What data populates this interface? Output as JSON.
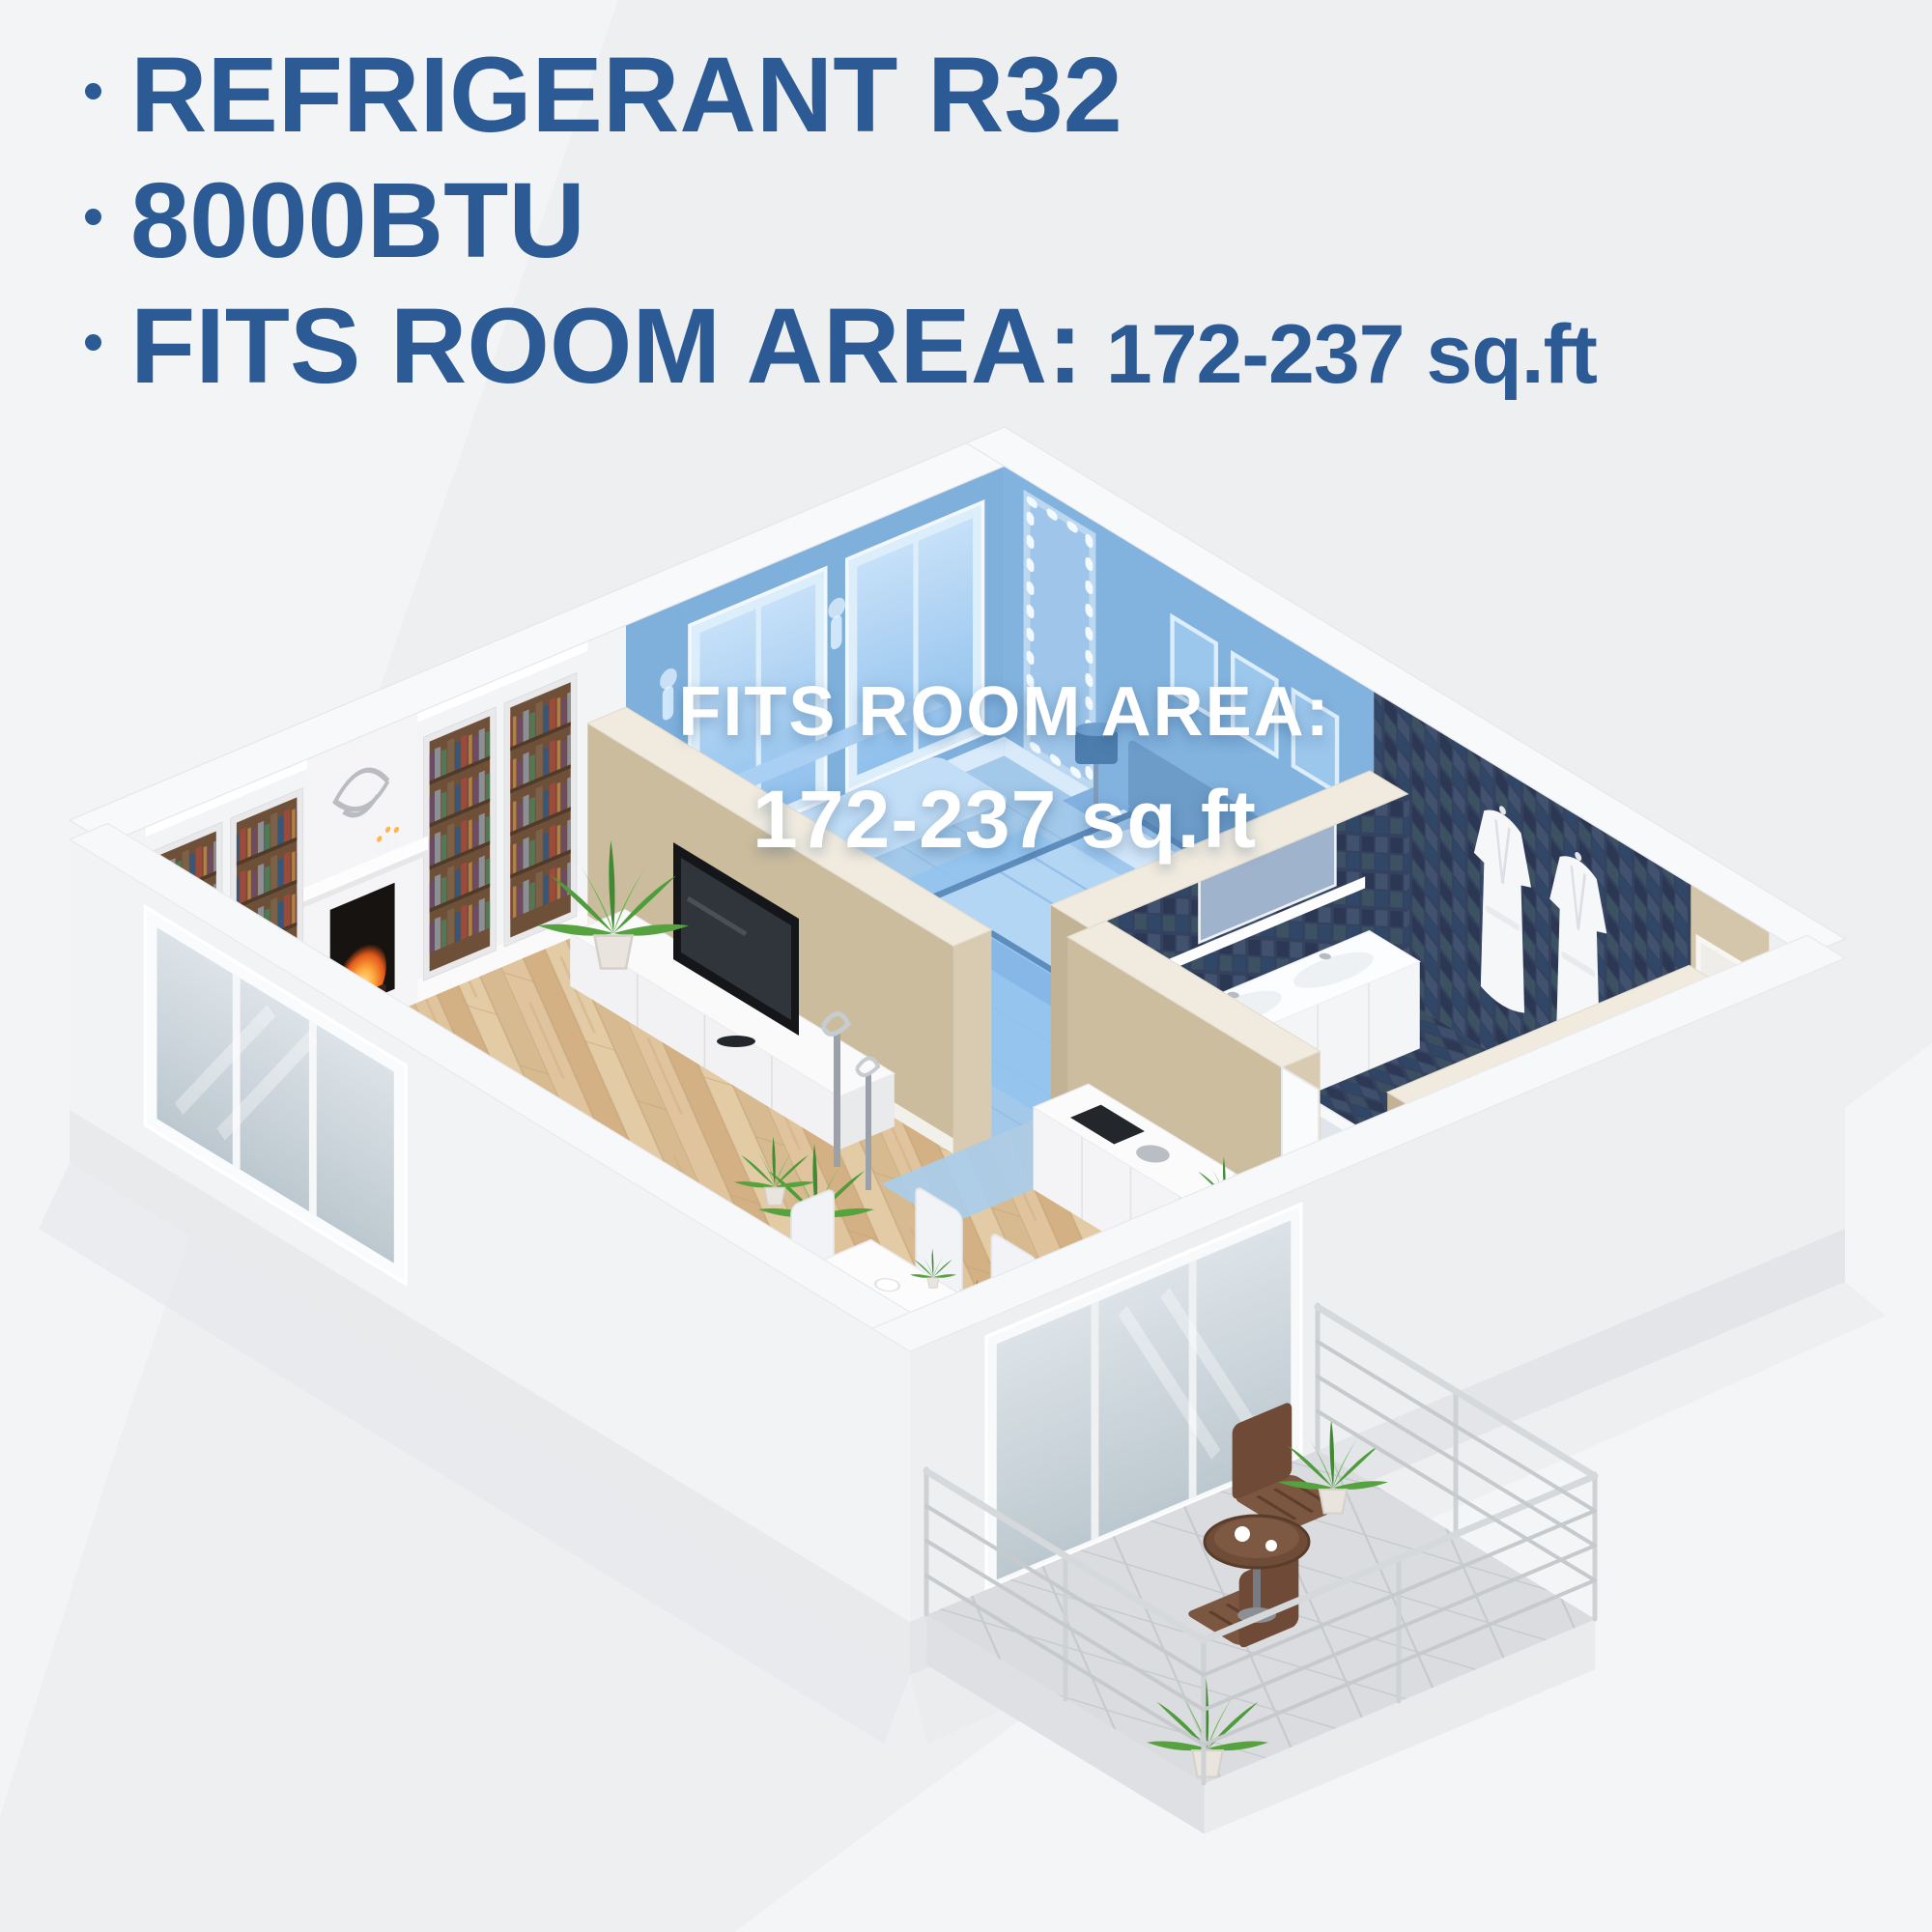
{
  "specs": {
    "items": [
      {
        "text": "REFRIGERANT R32"
      },
      {
        "text": "8000BTU"
      },
      {
        "text": "FITS ROOM AREA:",
        "value": "172-237 sq.ft"
      }
    ]
  },
  "highlight_label": {
    "line1": "FITS ROOM AREA:",
    "line2": "172-237 sq.ft"
  },
  "colors": {
    "heading_blue": "#2b5a94",
    "background": "#edeff1",
    "highlight_wall": "#7fb0dc",
    "highlight_wall_right": "#82b2de",
    "highlight_floor": "#a3c9ea",
    "wood_floor": "#dcc19b",
    "tan_wall": "#ccbc9e",
    "dark_tile": "#35425f",
    "white_wall": "#f3f4f6",
    "balcony_floor": "#dadcdf",
    "plant_green": "#4e9c3c",
    "table_brown": "#6f4c38"
  }
}
